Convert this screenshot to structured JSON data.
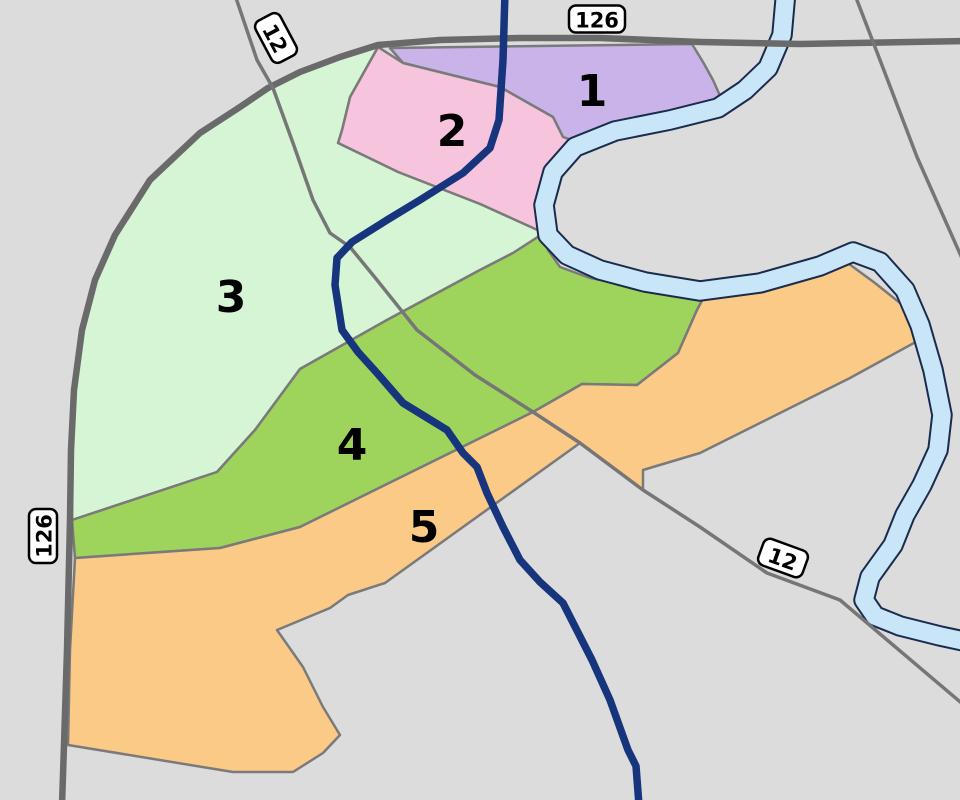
{
  "map": {
    "background_color": "#dcdcdc",
    "zone_border_color": "#7a7a7a",
    "zone_border_width": 2.5,
    "label_color": "#000000",
    "label_font_size": 44,
    "zones": [
      {
        "id": "1",
        "label": "1",
        "color": "#c9b3e8",
        "label_x": 592,
        "label_y": 90,
        "points": "390,48 692,44 703,62 713,80 725,107 700,111 670,117 640,127 617,132 580,143 563,137 553,117 500,87 403,63"
      },
      {
        "id": "2",
        "label": "2",
        "color": "#f7c4de",
        "label_x": 452,
        "label_y": 130,
        "points": "378,47 403,63 500,87 553,117 563,137 580,143 563,155 550,170 544,190 543,212 544,233 480,204 398,172 338,143 342,130 350,97"
      },
      {
        "id": "3",
        "label": "3",
        "color": "#d5f5d5",
        "label_x": 231,
        "label_y": 296,
        "points": "378,47 350,97 342,130 338,143 398,172 480,204 544,233 513,253 480,270 387,320 300,369 255,430 217,472 72,520 71,450 74,390 82,330 95,280 115,235 150,180 200,133 240,107 268,88 300,72 340,57"
      },
      {
        "id": "4",
        "label": "4",
        "color": "#9fd45c",
        "label_x": 352,
        "label_y": 444,
        "points": "72,520 217,472 255,430 300,369 387,320 480,270 513,253 544,233 548,250 560,267 590,278 640,287 675,291 705,295 697,310 678,353 637,385 582,384 533,412 300,527 220,548 75,558"
      },
      {
        "id": "5",
        "label": "5",
        "color": "#fbca86",
        "label_x": 424,
        "label_y": 526,
        "points": "75,558 220,548 300,527 533,412 582,384 637,385 678,353 697,310 705,295 760,284 820,268 845,261 875,283 905,307 923,338 850,378 700,453 643,470 643,490 580,443 385,583 348,595 330,608 277,630 303,667 323,707 340,735 323,753 293,772 233,772 68,745 70,650"
      }
    ],
    "river": {
      "fill_color": "#c9e6f9",
      "outline_color": "#1a2b4d",
      "width": 17.5,
      "outline_width": 21.5,
      "path": "M786,-10 L782,35 768,68 745,90 718,108 670,120 615,131 575,147 553,172 544,205 548,235 567,255 600,270 645,282 700,291 760,283 820,266 853,252 880,262 905,290 920,325 933,370 942,415 938,450 922,485 905,515 893,545 870,577 864,600 875,616 900,626 940,636 968,642"
    },
    "roads": [
      {
        "name": "route-126-road",
        "color": "#6a6a6a",
        "width": 6.5,
        "path": "M62,805 L64,745 67,650 70,520 71,450 74,390 82,330 95,280 115,235 150,180 200,133 240,107 268,88 300,72 340,57 378,45 440,40 520,38 600,38 700,42 800,44 965,41"
      },
      {
        "name": "route-12-road",
        "color": "#767676",
        "width": 3.5,
        "path": "M235,-5 L257,60 273,88 293,143 313,200 330,233 350,247 377,280 417,330 475,375 533,412 580,443 643,490 700,527 767,573 840,600 965,706"
      },
      {
        "name": "northeast-road",
        "color": "#767676",
        "width": 3.5,
        "path": "M855,-5 L880,60 917,157 965,265"
      }
    ],
    "route_line": {
      "color": "#16357d",
      "width": 7.5,
      "path": "M505,-8 L503,60 499,120 490,148 463,173 420,200 387,220 352,242 337,258 335,285 342,330 358,352 377,373 403,403 447,430 463,453 477,467 487,493 503,527 520,560 540,582 563,603 592,660 610,700 628,750 636,766 639,805"
    },
    "shields": [
      {
        "name": "route-shield-126-top",
        "label": "126",
        "x": 597,
        "y": 19,
        "rotation": 0,
        "w": 56,
        "h": 27
      },
      {
        "name": "route-shield-12-topleft",
        "label": "12",
        "x": 276,
        "y": 38,
        "rotation": 62,
        "w": 47,
        "h": 28
      },
      {
        "name": "route-shield-126-left",
        "label": "126",
        "x": 43,
        "y": 536,
        "rotation": -90,
        "w": 54,
        "h": 28
      },
      {
        "name": "route-shield-12-bottomright",
        "label": "12",
        "x": 783,
        "y": 558,
        "rotation": 20,
        "w": 47,
        "h": 28
      }
    ],
    "shield_style": {
      "fill": "#ffffff",
      "border": "#000000",
      "border_width": 2.5,
      "radius": 7,
      "font_size": 21,
      "text_color": "#000000"
    }
  }
}
